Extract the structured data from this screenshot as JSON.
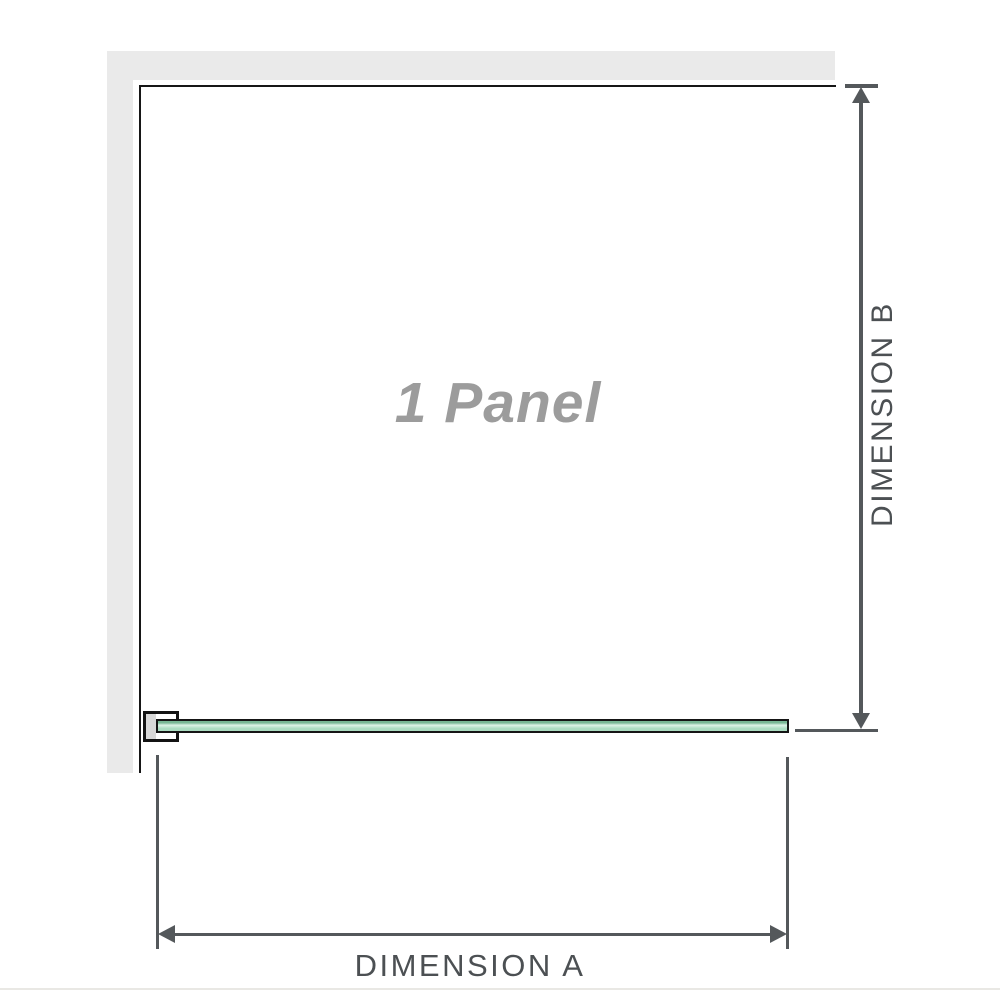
{
  "diagram": {
    "panel_label": "1 Panel",
    "dimension_a_label": "DIMENSION A",
    "dimension_b_label": "DIMENSION B",
    "colors": {
      "wall_fill": "#eaeaea",
      "panel_outline": "#161616",
      "dimension_line": "#54585b",
      "dimension_text": "#4c5053",
      "panel_label_text": "#9c9c9c",
      "glass_fill_light": "#dcf2e5",
      "glass_fill_mid": "#abdcc1",
      "glass_fill_dark": "#78b794",
      "glass_border": "#151515",
      "bracket_border": "#131313",
      "bracket_wall_insert": "#d8d8d8",
      "baseline_rule": "#e9e8e4"
    }
  }
}
